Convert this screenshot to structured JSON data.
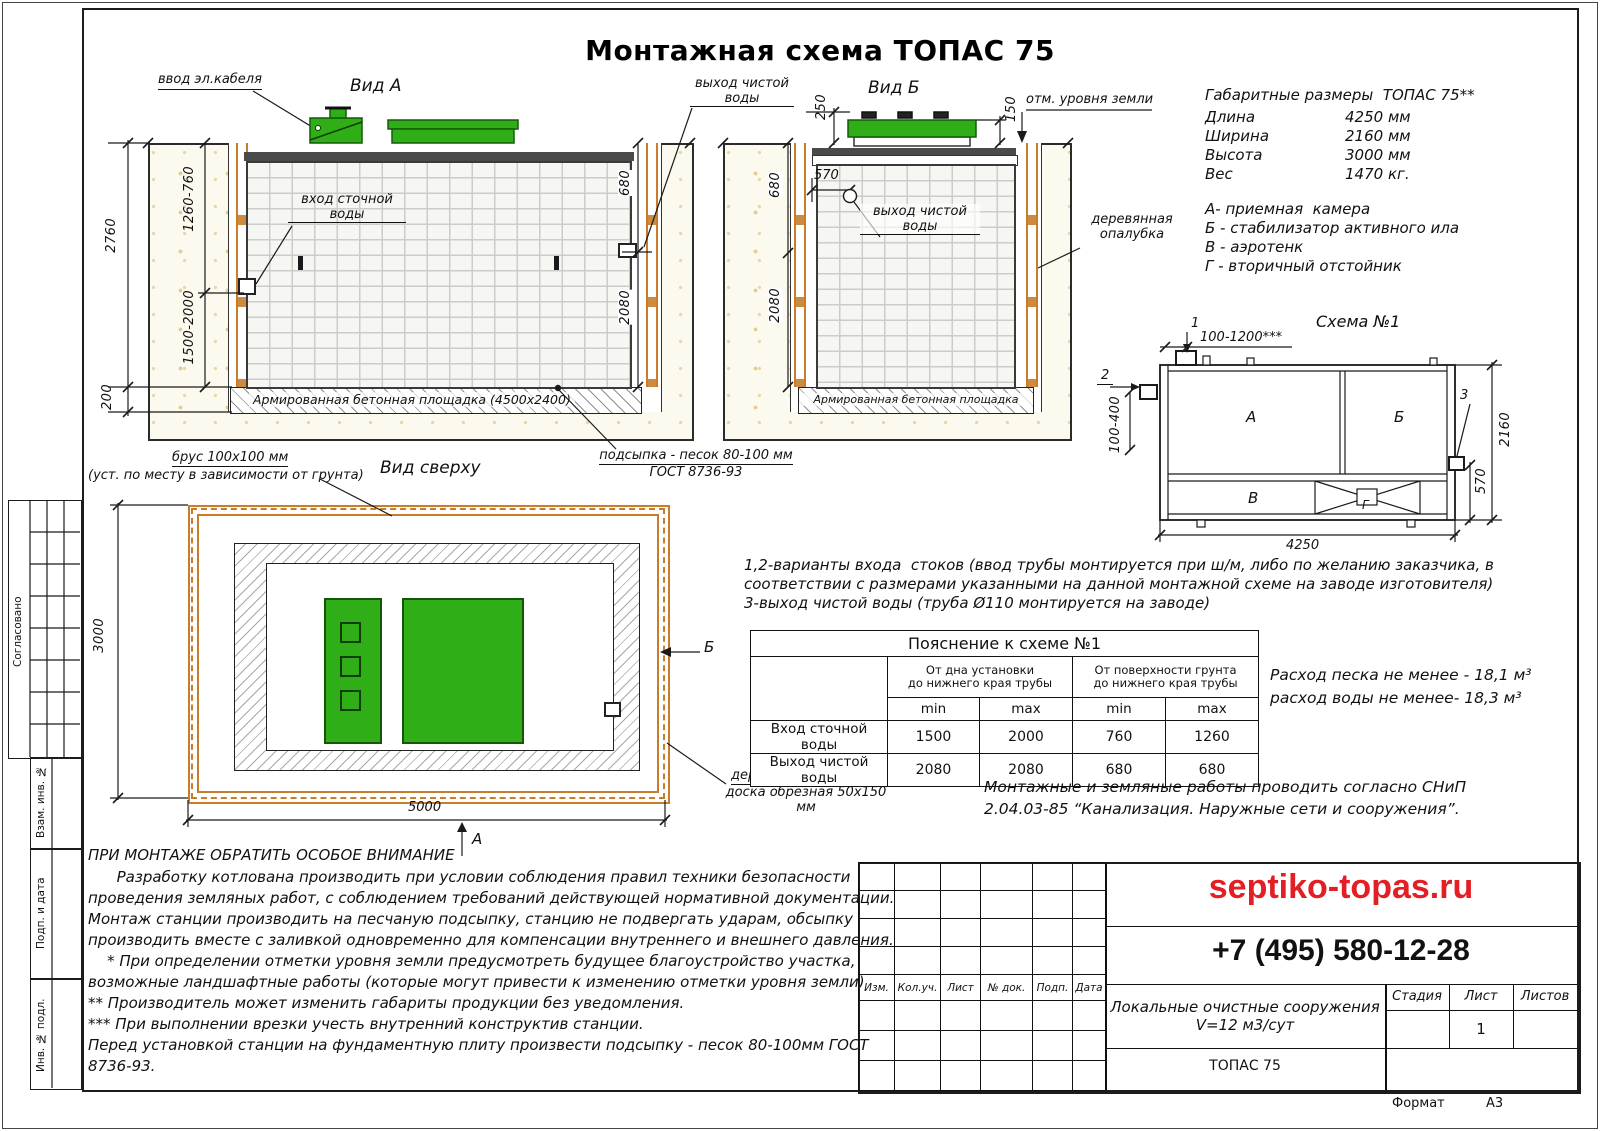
{
  "page": {
    "title": "Монтажная схема ТОПАС 75",
    "format_label": "Формат",
    "format_value": "А3"
  },
  "sidebar": {
    "agreed": "Согласовано",
    "replace_inv": "Взам. инв. №",
    "sign_date": "Подп. и дата",
    "inv_orig": "Инв. № подл."
  },
  "view_a": {
    "title": "Вид А",
    "cable": "ввод эл.кабеля",
    "inlet": "вход сточной воды",
    "outlet": "выход чистой воды",
    "dim_2760": "2760",
    "dim_1260_760": "1260-760",
    "dim_1500_2000": "1500-2000",
    "dim_200": "200",
    "dim_680": "680",
    "dim_2080": "2080",
    "slab": "Армированная бетонная площадка (4500х2400)"
  },
  "view_b": {
    "title": "Вид Б",
    "dim_250": "250",
    "dim_150": "150",
    "dim_680": "680",
    "dim_570": "570",
    "dim_2080": "2080",
    "ground": "отм. уровня земли",
    "outlet": "выход чистой воды",
    "formwork": "деревянная опалубка",
    "slab": "Армированная бетонная площадка"
  },
  "sand": {
    "line1": "подсыпка - песок 80-100 мм",
    "line2": "ГОСТ 8736-93"
  },
  "overall": {
    "title": "Габаритные размеры  ТОПАС 75**",
    "rows": [
      [
        "Длина",
        "4250 мм"
      ],
      [
        "Ширина",
        "2160 мм"
      ],
      [
        "Высота",
        "3000 мм"
      ],
      [
        "Вес",
        "1470 кг."
      ]
    ]
  },
  "legend": [
    "А- приемная  камера",
    "Б - стабилизатор активного ила",
    "В - аэротенк",
    "Г - вторичный отстойник"
  ],
  "schema": {
    "title": "Схема №1",
    "m1": "1",
    "m2": "2",
    "m3": "3",
    "dim_top": "100-1200***",
    "dim_left": "100-400",
    "dim_right": "2160",
    "dim_570": "570",
    "dim_bottom": "4250",
    "a": "А",
    "b": "Б",
    "v": "В",
    "g": "Г"
  },
  "top_view": {
    "title": "Вид сверху",
    "beam1": "брус 100х100 мм",
    "beam2": "(уст. по месту в зависимости от грунта)",
    "dim_3000": "3000",
    "dim_5000": "5000",
    "arrow_b": "Б",
    "arrow_a": "А",
    "formwork1": "деревянная опалубка",
    "formwork2": "доска обрезная 50х150 мм"
  },
  "variants": [
    "1,2-варианты входа  стоков (ввод трубы монтируется при ш/м, либо по желанию заказчика, в",
    "соответствии с размерами указанными на данной монтажной схеме на заводе изготовителя)",
    "3-выход чистой воды (труба Ø110 монтируется на заводе)"
  ],
  "table": {
    "title": "Пояснение к схеме №1",
    "g1a": "От дна установки",
    "g1b": "до нижнего края трубы",
    "g2a": "От поверхности грунта",
    "g2b": "до нижнего края трубы",
    "min": "min",
    "max": "max",
    "rows": [
      {
        "label": "Вход сточной воды",
        "v": [
          "1500",
          "2000",
          "760",
          "1260"
        ]
      },
      {
        "label": "Выход чистой воды",
        "v": [
          "2080",
          "2080",
          "680",
          "680"
        ]
      }
    ]
  },
  "consumption": [
    "Расход песка не менее - 18,1 м³",
    "расход воды не менее- 18,3 м³"
  ],
  "snip": [
    "Монтажные и земляные работы проводить согласно СНиП",
    "2.04.03-85 “Канализация. Наружные сети и сооружения”."
  ],
  "attention": {
    "title": "ПРИ МОНТАЖЕ ОБРАТИТЬ ОСОБОЕ ВНИМАНИЕ",
    "lines": [
      "      Разработку котлована производить при условии соблюдения правил техники безопасности",
      "проведения земляных работ, с соблюдением требований действующей нормативной документации.",
      "Монтаж станции производить на песчаную подсыпку, станцию не подвергать ударам, обсыпку",
      "производить вместе с заливкой одновременно для компенсации внутреннего и внешнего давления.",
      "    * При определении отметки уровня земли предусмотреть будущее благоустройство участка,",
      "возможные ландшафтные работы (которые могут привести к изменению отметки уровня земли)",
      "** Производитель может изменить габариты продукции без уведомления.",
      "*** При выполнении врезки учесть внутренний конструктив станции.",
      "Перед установкой станции на фундаментную плиту произвести подсыпку - песок 80-100мм ГОСТ",
      "8736-93."
    ]
  },
  "stamp": {
    "rev_headers": [
      "Изм.",
      "Кол.уч.",
      "Лист",
      "№ док.",
      "Подп.",
      "Дата"
    ],
    "site": "septiko-topas.ru",
    "phone": "+7 (495) 580-12-28",
    "object1": "Локальные очистные сооружения",
    "object2": "V=12 м3/сут",
    "stage_label": "Стадия",
    "sheet_label": "Лист",
    "sheets_label": "Листов",
    "sheet_value": "1",
    "product": "ТОПАС 75"
  }
}
